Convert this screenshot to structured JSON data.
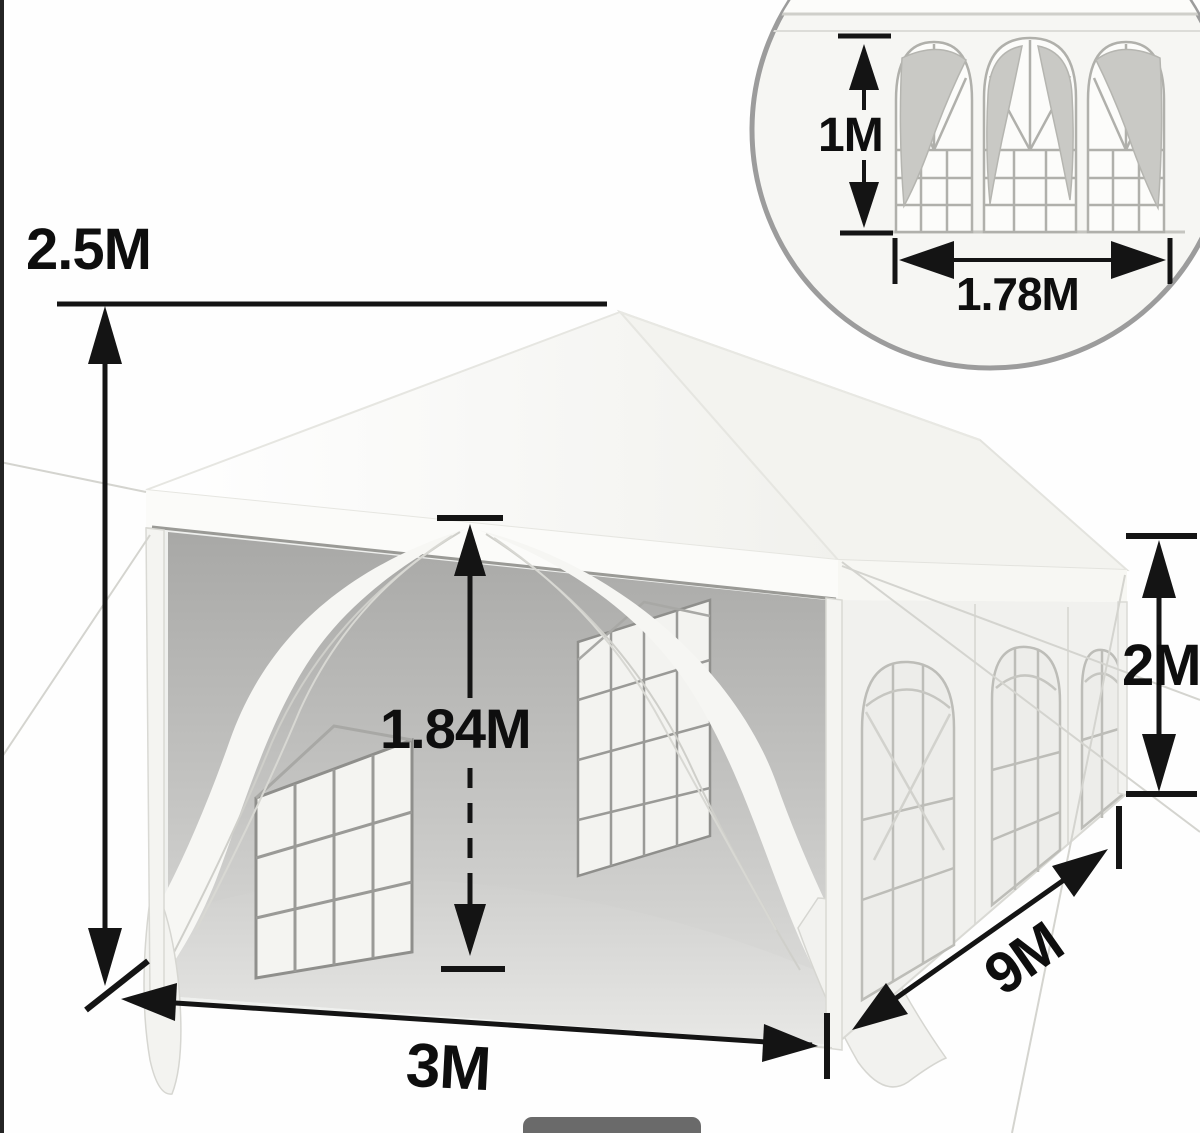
{
  "diagram": {
    "title": "party tent canopy dimension diagram",
    "labels": {
      "overall_height": "2.5M",
      "entrance_height": "1.84M",
      "front_width": "3M",
      "side_length": "9M",
      "sidewall_height": "2M"
    },
    "inset": {
      "window_height": "1M",
      "window_width": "1.78M"
    },
    "colors": {
      "annotation_black": "#141414",
      "tent_white": "#f7f7f4",
      "interior_gray": "#adadab",
      "ring_gray": "#9c9c9c",
      "pill_gray": "#6a6a6a",
      "edge_strip": "#242424"
    }
  }
}
